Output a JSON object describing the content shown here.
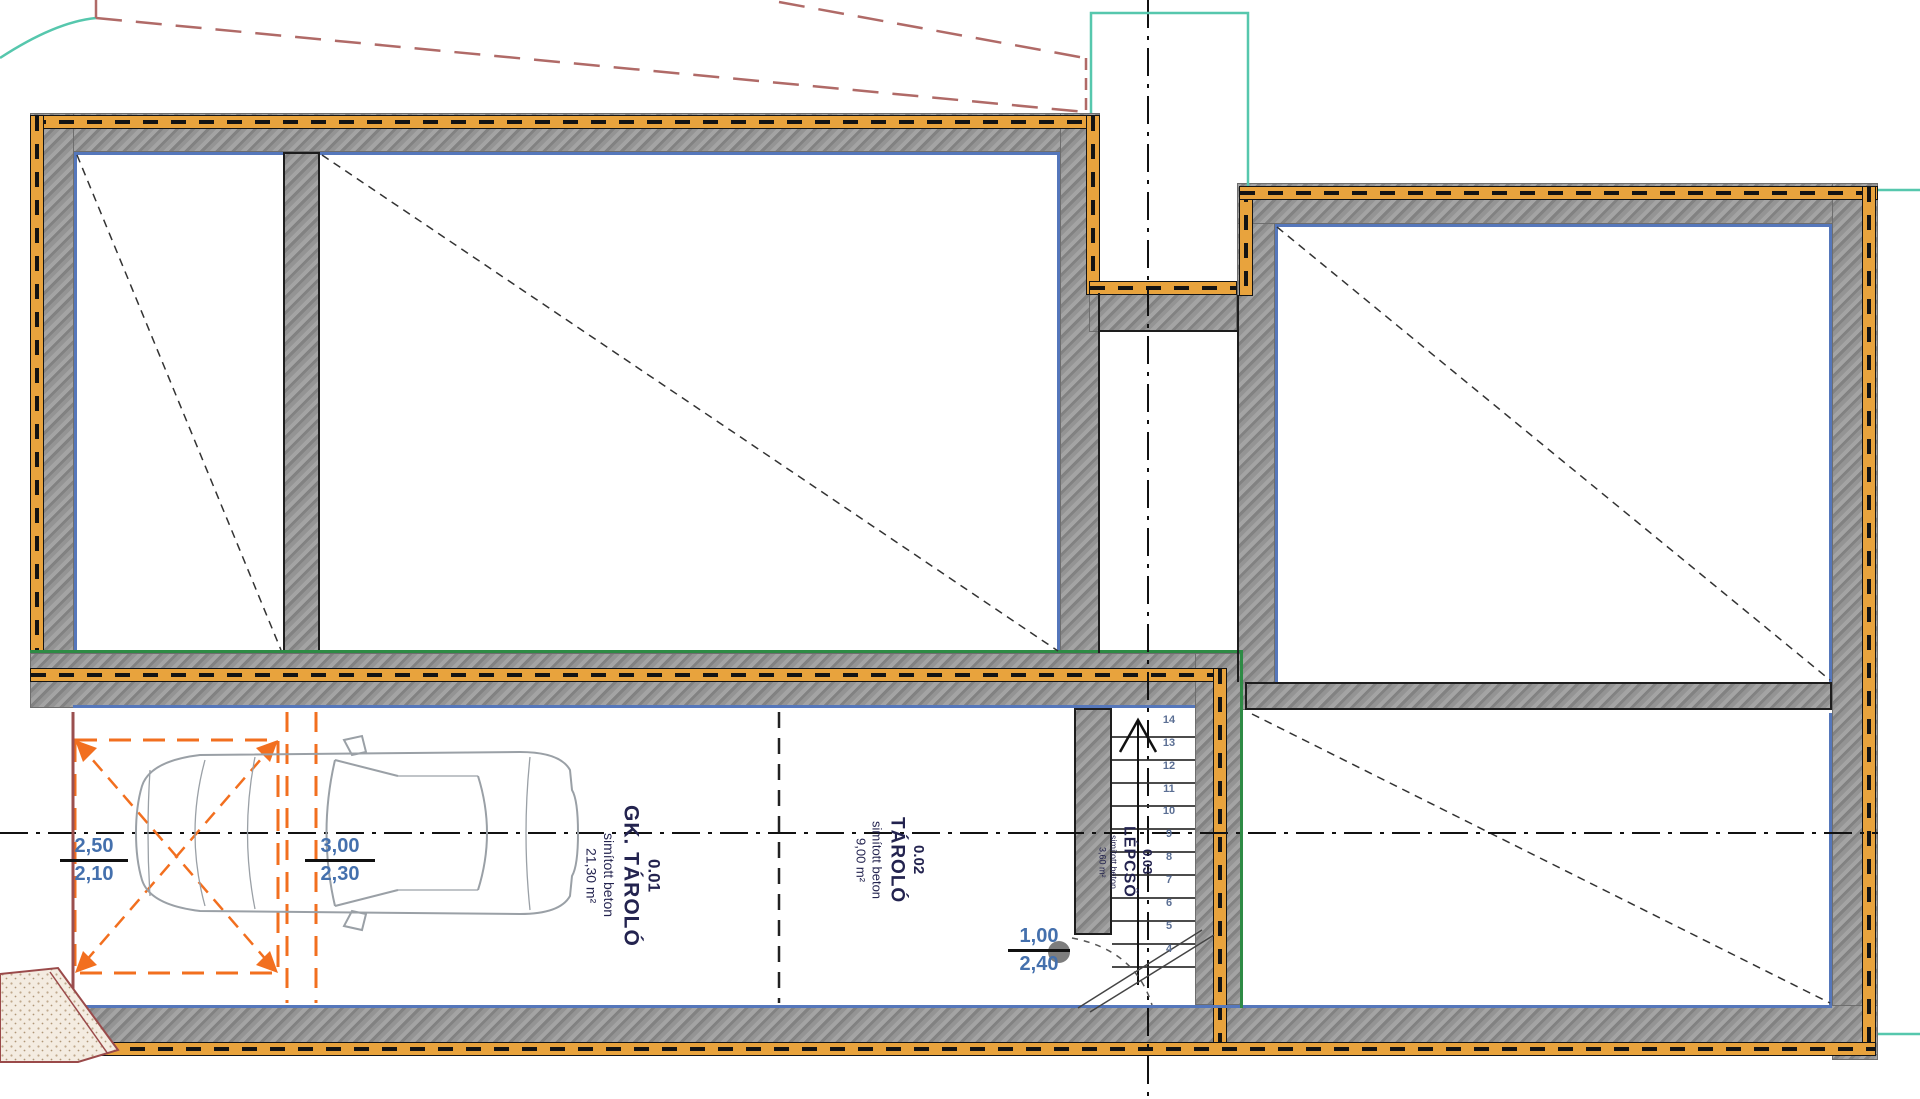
{
  "drawing": {
    "type": "basement floor plan",
    "rooms": [
      {
        "id": "0.01",
        "name": "GK. TÁROLÓ",
        "material": "simított beton",
        "area": "21,30 m²"
      },
      {
        "id": "0.02",
        "name": "TÁROLÓ",
        "material": "simított beton",
        "area": "9,00 m²"
      },
      {
        "id": "0.03",
        "name": "LÉPCSŐ",
        "material": "simított beton",
        "area": "3,60 m²"
      }
    ],
    "dimensions": [
      {
        "top": "2,50",
        "bottom": "2,10"
      },
      {
        "top": "3,00",
        "bottom": "2,30"
      },
      {
        "top": "1,00",
        "bottom": "2,40"
      }
    ],
    "stair_treads": [
      "14",
      "13",
      "12",
      "11",
      "10",
      "9",
      "8",
      "7",
      "6",
      "5",
      "4"
    ],
    "colors": {
      "insulation_gold": "#e8a33d",
      "wall_hatch_gray": "#8f8f8f",
      "room_line_blue": "#5577bb",
      "envelope_green": "#2e8b45",
      "boundary_teal": "#56c7ad",
      "parking_orange": "#f26f1f",
      "dimension_blue": "#4470ad",
      "label_navy": "#23234f",
      "terrain_red": "#b06a67"
    }
  }
}
